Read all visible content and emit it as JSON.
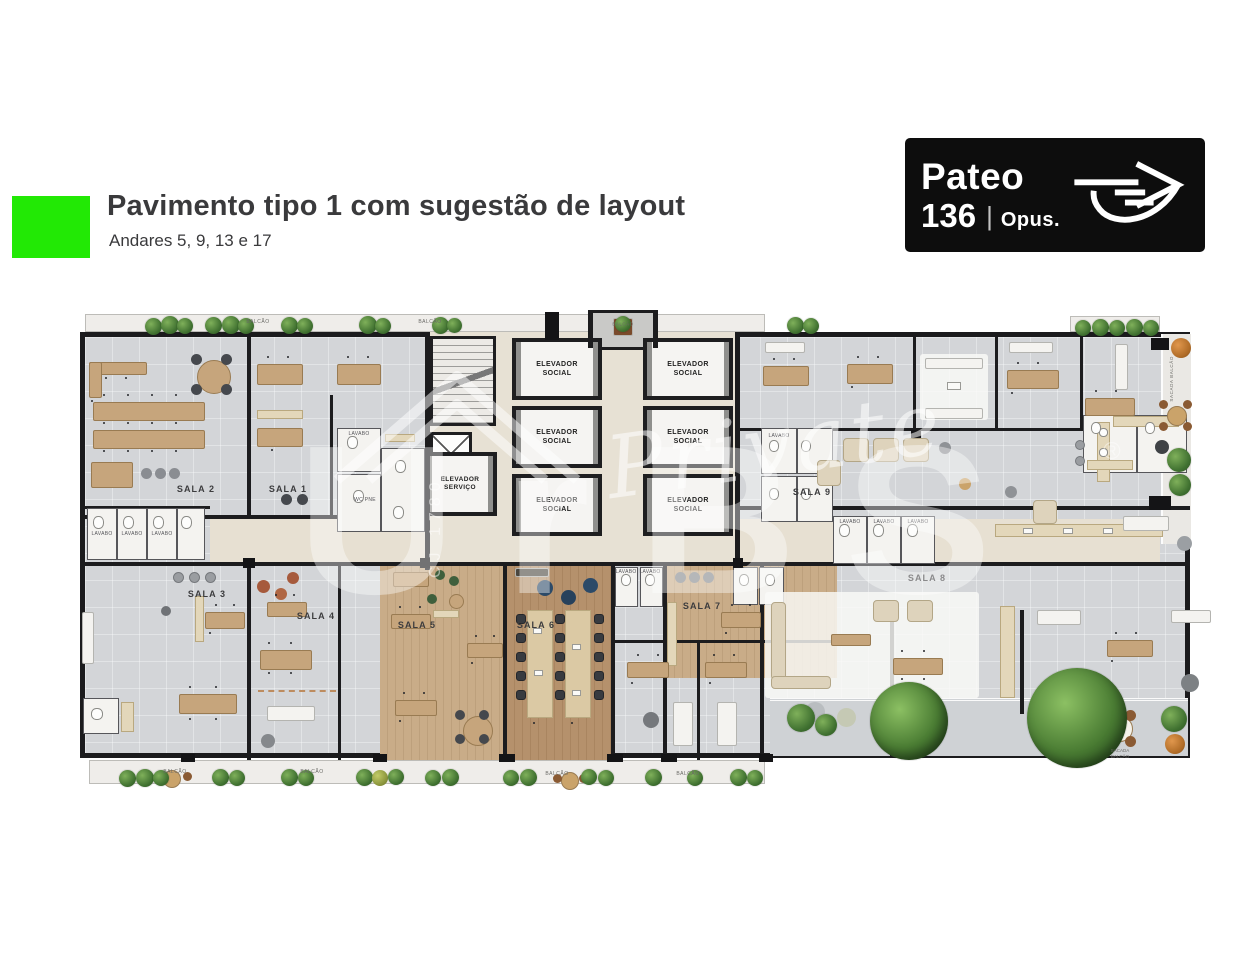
{
  "header": {
    "title": "Pavimento tipo 1 com sugestão de layout",
    "subtitle": "Andares 5, 9, 13 e 17",
    "accent_color": "#22E905",
    "title_color": "#3A3A3C"
  },
  "logo": {
    "name": "Pateo",
    "number": "136",
    "divider": "|",
    "brand": "Opus.",
    "bg": "#0D0D0D",
    "icon": "leaf-arrow-icon"
  },
  "floorplan": {
    "rooms": [
      {
        "label": "SALA 1"
      },
      {
        "label": "SALA 2"
      },
      {
        "label": "SALA 3"
      },
      {
        "label": "SALA 4"
      },
      {
        "label": "SALA 5"
      },
      {
        "label": "SALA 6"
      },
      {
        "label": "SALA 7"
      },
      {
        "label": "SALA 8"
      },
      {
        "label": "SALA 9"
      }
    ],
    "elevators": {
      "social_label": "ELEVADOR SOCIAL",
      "service_label": "ELEVADOR SERVIÇO",
      "social_count": 6
    },
    "labels": {
      "balcony": "BALCÃO",
      "lavatory": "LAVABO",
      "accessible_wc": "WC PNE",
      "terrace": "SACADA BALCÃO"
    },
    "watermark": {
      "script": "Private",
      "brand": "UrBS",
      "registered": "®",
      "license": "CJ 1780"
    },
    "colors": {
      "wall": "#1C1C1E",
      "floor": "#D3D5D8",
      "corridor": "#E7E0D2",
      "wood_light": "#C9AC88",
      "wood_dark": "#B5916C",
      "terrace": "#CFD2D5",
      "desk": "#C6A57C",
      "chair": "#383B40",
      "plant": "#4E7D36"
    }
  }
}
